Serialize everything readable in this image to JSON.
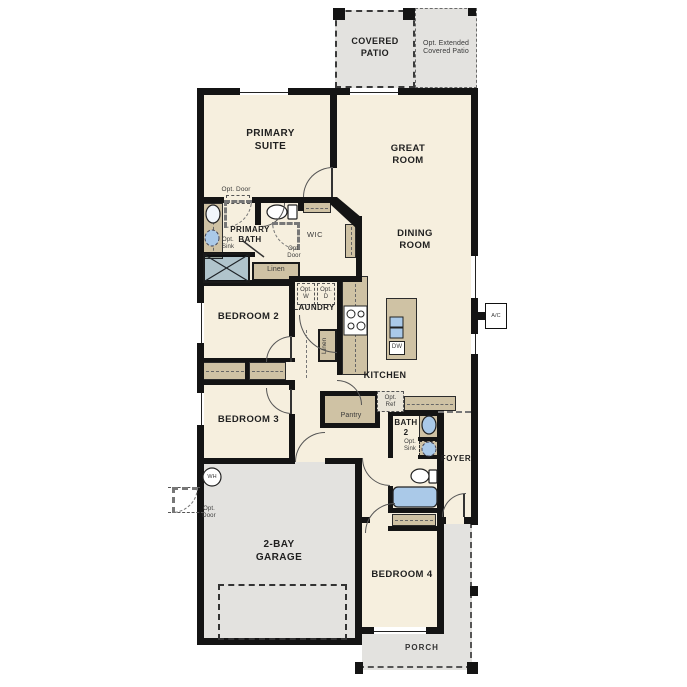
{
  "colors": {
    "wall": "#141414",
    "cream": "#f6efde",
    "outdoor": "#e3e2df",
    "tan": "#cfc2a4",
    "blue": "#aac9e8",
    "line": "#555",
    "label": "#1f1f1f",
    "small": "#3a3a3a"
  },
  "labels": {
    "covered_patio": "COVERED\nPATIO",
    "opt_extended_patio": "Opt. Extended\nCovered Patio",
    "primary_suite": "PRIMARY\nSUITE",
    "great_room": "GREAT\nROOM",
    "dining_room": "DINING\nROOM",
    "opt_door": "Opt. Door",
    "opt_door_2l": "Opt.\nDoor",
    "primary_bath": "PRIMARY\nBATH",
    "opt_sink": "Opt.\nSink",
    "wic": "WIC",
    "linen": "Linen",
    "opt_w": "Opt.\nW",
    "opt_d": "Opt.\nD",
    "laundry": "LAUNDRY",
    "bedroom2": "BEDROOM 2",
    "bedroom3": "BEDROOM 3",
    "kitchen": "KITCHEN",
    "dw": "DW",
    "opt_ref": "Opt.\nRef",
    "pantry": "Pantry",
    "bath2": "BATH\n2",
    "foyer": "FOYER",
    "wh": "WH",
    "garage": "2-BAY\nGARAGE",
    "bedroom4": "BEDROOM 4",
    "porch": "PORCH",
    "ac": "A/C"
  }
}
